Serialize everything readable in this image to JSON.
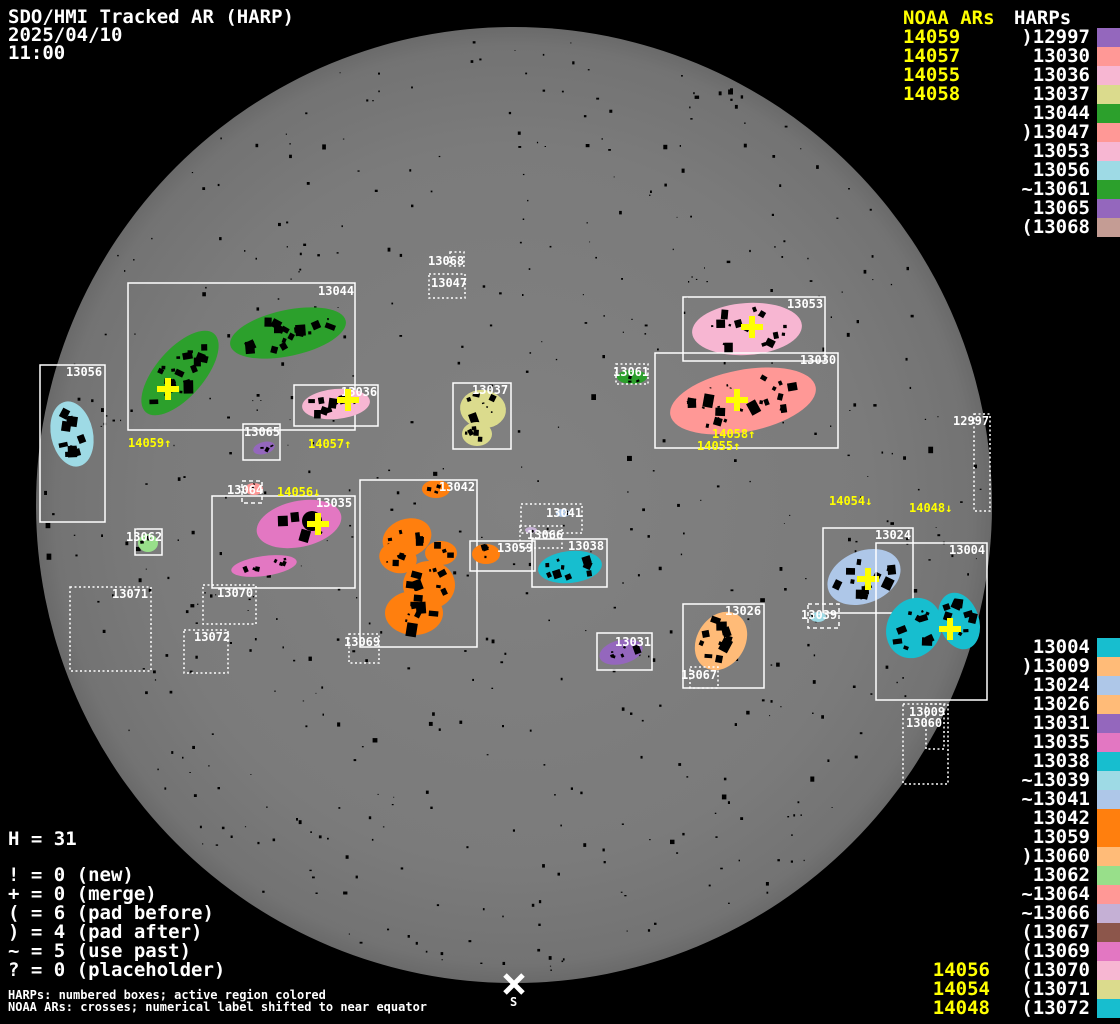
{
  "header": {
    "title": "SDO/HMI Tracked AR (HARP)",
    "date": "2025/04/10",
    "time": "11:00"
  },
  "panel_top_right": {
    "noaa_title": "NOAA ARs",
    "harps_title": "HARPs",
    "noaa_values": [
      "14059",
      "14057",
      "14055",
      "14058"
    ],
    "harps": [
      {
        "label": ")12997",
        "color": "#9467bd"
      },
      {
        "label": "13030",
        "color": "#ff9896"
      },
      {
        "label": "13036",
        "color": "#f7b6d2"
      },
      {
        "label": "13037",
        "color": "#dbdb8d"
      },
      {
        "label": "13044",
        "color": "#2ca02c"
      },
      {
        "label": ")13047",
        "color": "#ff9896"
      },
      {
        "label": "13053",
        "color": "#f7b6d2"
      },
      {
        "label": "13056",
        "color": "#9edae5"
      },
      {
        "label": "~13061",
        "color": "#2ca02c"
      },
      {
        "label": "13065",
        "color": "#9467bd"
      },
      {
        "label": "(13068",
        "color": "#c49c94"
      }
    ]
  },
  "panel_bottom_right": {
    "harps": [
      {
        "label": "13004",
        "color": "#17becf"
      },
      {
        "label": ")13009",
        "color": "#ffbb78"
      },
      {
        "label": "13024",
        "color": "#aec7e8"
      },
      {
        "label": "13026",
        "color": "#ffbb78"
      },
      {
        "label": "13031",
        "color": "#9467bd"
      },
      {
        "label": "13035",
        "color": "#e377c2"
      },
      {
        "label": "13038",
        "color": "#17becf"
      },
      {
        "label": "~13039",
        "color": "#9edae5"
      },
      {
        "label": "~13041",
        "color": "#aec7e8"
      },
      {
        "label": "13042",
        "color": "#ff7f0e"
      },
      {
        "label": "13059",
        "color": "#ff7f0e"
      },
      {
        "label": ")13060",
        "color": "#ffbb78"
      },
      {
        "label": "13062",
        "color": "#98df8a"
      },
      {
        "label": "~13064",
        "color": "#ff9896"
      },
      {
        "label": "~13066",
        "color": "#c5b0d5"
      },
      {
        "label": "(13067",
        "color": "#8c564b"
      },
      {
        "label": "(13069",
        "color": "#e377c2"
      },
      {
        "label": "(13070",
        "color": "#f7b6d2"
      },
      {
        "label": "(13071",
        "color": "#dbdb8d"
      },
      {
        "label": "(13072",
        "color": "#17becf"
      }
    ],
    "noaa_values": [
      "14056",
      "14054",
      "14048"
    ]
  },
  "legend": {
    "h_line": "H = 31",
    "lines": [
      "! = 0 (new)",
      "+ = 0 (merge)",
      "( = 6 (pad before)",
      ") = 4 (pad after)",
      "~ = 5 (use past)",
      "? = 0 (placeholder)"
    ],
    "footnote1": "HARPs: numbered boxes; active region colored",
    "footnote2": "NOAA ARs: crosses; numerical label shifted to near equator"
  },
  "disk": {
    "cx": 514,
    "cy": 505,
    "r": 478,
    "south_label": "S",
    "south_x": 514,
    "south_y": 984
  },
  "colors": {
    "noaa": "#ffff00",
    "box": "#ffffff",
    "label": "#ffffff",
    "speck": "#000000"
  },
  "regions": [
    {
      "id": "13044",
      "box": [
        128,
        283,
        227,
        147
      ],
      "style": "solid",
      "color": "#2ca02c",
      "label": [
        318,
        285
      ],
      "blobs": [
        [
          180,
          373,
          52,
          24,
          -49,
          20
        ],
        [
          288,
          333,
          59,
          23,
          -12,
          20
        ]
      ],
      "cross": [
        168,
        389
      ]
    },
    {
      "id": "13056",
      "box": [
        40,
        365,
        65,
        157
      ],
      "style": "solid",
      "color": "#9edae5",
      "label": [
        66,
        366
      ],
      "blobs": [
        [
          72,
          434,
          21,
          33,
          -12,
          12
        ]
      ]
    },
    {
      "id": "13036",
      "box": [
        294,
        385,
        84,
        41
      ],
      "style": "solid",
      "color": "#f7b6d2",
      "label": [
        341,
        386
      ],
      "blobs": [
        [
          336,
          404,
          34,
          15,
          -5,
          10
        ]
      ],
      "cross": [
        348,
        400
      ]
    },
    {
      "id": "13065",
      "box": [
        243,
        424,
        37,
        36
      ],
      "style": "solid",
      "color": "#9467bd",
      "label": [
        244,
        426
      ],
      "blobs": [
        [
          264,
          448,
          11,
          6,
          -15,
          3
        ]
      ]
    },
    {
      "id": "13037",
      "box": [
        453,
        383,
        58,
        66
      ],
      "style": "solid",
      "color": "#dbdb8d",
      "label": [
        472,
        384
      ],
      "blobs": [
        [
          483,
          409,
          23,
          19,
          8,
          8
        ],
        [
          477,
          434,
          15,
          12,
          0,
          5
        ]
      ]
    },
    {
      "id": "13047",
      "box": [
        429,
        274,
        36,
        24
      ],
      "style": "dotted",
      "color": null,
      "label": [
        431,
        277
      ],
      "blobs": []
    },
    {
      "id": "13068",
      "box": [
        450,
        252,
        14,
        14
      ],
      "style": "dotted",
      "color": null,
      "label": [
        428,
        255
      ],
      "blobs": []
    },
    {
      "id": "13061",
      "box": [
        616,
        364,
        32,
        20
      ],
      "style": "dotted",
      "color": "#2ca02c",
      "label": [
        613,
        366
      ],
      "blobs": [
        [
          632,
          377,
          15,
          7,
          0,
          3
        ]
      ]
    },
    {
      "id": "13053",
      "box": [
        683,
        297,
        142,
        64
      ],
      "style": "solid",
      "color": "#f7b6d2",
      "label": [
        787,
        298
      ],
      "blobs": [
        [
          747,
          329,
          55,
          26,
          -4,
          16
        ]
      ],
      "cross": [
        752,
        327
      ]
    },
    {
      "id": "13030",
      "box": [
        655,
        353,
        183,
        95
      ],
      "style": "solid",
      "color": "#ff9896",
      "label": [
        800,
        354
      ],
      "blobs": [
        [
          743,
          401,
          74,
          31,
          -11,
          26
        ]
      ],
      "cross": [
        737,
        400
      ]
    },
    {
      "id": "13035",
      "box": [
        212,
        496,
        143,
        92
      ],
      "style": "solid",
      "color": "#e377c2",
      "label": [
        316,
        497
      ],
      "blobs": [
        [
          299,
          524,
          43,
          23,
          -12,
          5
        ],
        [
          264,
          566,
          33,
          10,
          -8,
          7
        ]
      ],
      "cross": [
        318,
        524
      ],
      "dark": [
        312,
        521,
        10
      ]
    },
    {
      "id": "13064",
      "box": [
        242,
        481,
        20,
        22
      ],
      "style": "dashed",
      "color": "#ff9896",
      "label": [
        227,
        484
      ],
      "blobs": [
        [
          254,
          489,
          9,
          6,
          0,
          2
        ]
      ]
    },
    {
      "id": "13070",
      "box": [
        203,
        585,
        53,
        39
      ],
      "style": "dotted",
      "color": null,
      "label": [
        217,
        587
      ],
      "blobs": []
    },
    {
      "id": "13071",
      "box": [
        70,
        587,
        81,
        84
      ],
      "style": "dotted",
      "color": null,
      "label": [
        112,
        588
      ],
      "blobs": []
    },
    {
      "id": "13072",
      "box": [
        184,
        630,
        44,
        43
      ],
      "style": "dotted",
      "color": null,
      "label": [
        194,
        631
      ],
      "blobs": []
    },
    {
      "id": "13042",
      "box": [
        360,
        480,
        117,
        167
      ],
      "style": "solid",
      "color": "#ff7f0e",
      "label": [
        439,
        481
      ],
      "blobs": [
        [
          407,
          538,
          25,
          19,
          -20,
          6
        ],
        [
          398,
          558,
          19,
          15,
          15,
          5
        ],
        [
          429,
          585,
          26,
          24,
          0,
          9
        ],
        [
          414,
          613,
          29,
          22,
          0,
          9
        ],
        [
          441,
          553,
          16,
          12,
          0,
          4
        ],
        [
          436,
          489,
          14,
          9,
          0,
          3
        ]
      ]
    },
    {
      "id": "13069",
      "box": [
        349,
        634,
        30,
        29
      ],
      "style": "dotted",
      "color": null,
      "label": [
        344,
        636
      ],
      "blobs": []
    },
    {
      "id": "13059",
      "box": [
        470,
        541,
        65,
        30
      ],
      "style": "solid",
      "color": "#ff7f0e",
      "label": [
        497,
        542
      ],
      "blobs": [
        [
          486,
          554,
          14,
          10,
          0,
          4
        ]
      ]
    },
    {
      "id": "13041",
      "box": [
        521,
        504,
        61,
        29
      ],
      "style": "dotted",
      "color": "#aec7e8",
      "label": [
        546,
        507
      ],
      "blobs": [
        [
          563,
          513,
          7,
          4,
          0,
          2
        ]
      ]
    },
    {
      "id": "13066",
      "box": [
        520,
        526,
        42,
        22
      ],
      "style": "dotted",
      "color": "#c5b0d5",
      "label": [
        527,
        529
      ],
      "blobs": [
        [
          531,
          530,
          6,
          3,
          0,
          1
        ]
      ]
    },
    {
      "id": "13038",
      "box": [
        532,
        539,
        75,
        48
      ],
      "style": "solid",
      "color": "#17becf",
      "label": [
        568,
        540
      ],
      "blobs": [
        [
          570,
          567,
          32,
          16,
          -6,
          9
        ]
      ]
    },
    {
      "id": "13062",
      "box": [
        135,
        529,
        27,
        26
      ],
      "style": "solid",
      "color": "#98df8a",
      "label": [
        126,
        531
      ],
      "blobs": [
        [
          148,
          543,
          10,
          9,
          0,
          3
        ]
      ]
    },
    {
      "id": "13031",
      "box": [
        597,
        633,
        55,
        37
      ],
      "style": "solid",
      "color": "#9467bd",
      "label": [
        615,
        636
      ],
      "blobs": [
        [
          621,
          652,
          22,
          12,
          -14,
          6
        ]
      ]
    },
    {
      "id": "13026",
      "box": [
        683,
        604,
        81,
        84
      ],
      "style": "solid",
      "color": "#ffbb78",
      "label": [
        725,
        605
      ],
      "blobs": [
        [
          721,
          641,
          24,
          31,
          32,
          12
        ]
      ]
    },
    {
      "id": "13067",
      "box": [
        690,
        667,
        28,
        21
      ],
      "style": "dotted",
      "color": null,
      "label": [
        681,
        669
      ],
      "blobs": []
    },
    {
      "id": "13024",
      "box": [
        823,
        528,
        90,
        85
      ],
      "style": "solid",
      "color": "#aec7e8",
      "label": [
        875,
        529
      ],
      "blobs": [
        [
          864,
          577,
          38,
          26,
          -22,
          14
        ]
      ],
      "cross": [
        868,
        579
      ]
    },
    {
      "id": "13004",
      "box": [
        876,
        543,
        111,
        157
      ],
      "style": "solid",
      "color": "#17becf",
      "label": [
        949,
        544
      ],
      "blobs": [
        [
          914,
          628,
          27,
          31,
          28,
          12
        ],
        [
          959,
          621,
          20,
          29,
          -18,
          10
        ]
      ],
      "cross": [
        950,
        629
      ]
    },
    {
      "id": "13039",
      "box": [
        808,
        604,
        31,
        24
      ],
      "style": "dashed",
      "color": "#9edae5",
      "label": [
        801,
        609
      ],
      "blobs": [
        [
          818,
          617,
          8,
          5,
          0,
          2
        ]
      ]
    },
    {
      "id": "13060",
      "box": [
        903,
        704,
        45,
        80
      ],
      "style": "dotted",
      "color": null,
      "label": [
        906,
        717
      ],
      "blobs": []
    },
    {
      "id": "13009",
      "box": [
        926,
        704,
        18,
        45
      ],
      "style": "dotted",
      "color": null,
      "label": [
        909,
        706
      ],
      "blobs": []
    },
    {
      "id": "12997",
      "box": [
        974,
        414,
        16,
        97
      ],
      "style": "dotted",
      "color": null,
      "label": [
        953,
        415
      ],
      "blobs": []
    }
  ],
  "noaa_disk_labels": [
    {
      "text": "14059↑",
      "x": 128,
      "y": 437
    },
    {
      "text": "14057↑",
      "x": 308,
      "y": 438
    },
    {
      "text": "14058↑",
      "x": 712,
      "y": 428
    },
    {
      "text": "14055↑",
      "x": 697,
      "y": 440
    },
    {
      "text": "14056↓",
      "x": 277,
      "y": 486
    },
    {
      "text": "14054↓",
      "x": 829,
      "y": 495
    },
    {
      "text": "14048↓",
      "x": 909,
      "y": 502
    }
  ],
  "chart_data": {
    "type": "table",
    "title": "SDO/HMI Tracked AR (HARP) 2025/04/10 11:00",
    "columns": [
      "HARP",
      "status_prefix",
      "color"
    ],
    "rows": [
      [
        ")12997",
        "pad after",
        "#9467bd"
      ],
      [
        "13030",
        "",
        "#ff9896"
      ],
      [
        "13036",
        "",
        "#f7b6d2"
      ],
      [
        "13037",
        "",
        "#dbdb8d"
      ],
      [
        "13044",
        "",
        "#2ca02c"
      ],
      [
        ")13047",
        "pad after",
        "#ff9896"
      ],
      [
        "13053",
        "",
        "#f7b6d2"
      ],
      [
        "13056",
        "",
        "#9edae5"
      ],
      [
        "~13061",
        "use past",
        "#2ca02c"
      ],
      [
        "13065",
        "",
        "#9467bd"
      ],
      [
        "(13068",
        "pad before",
        "#c49c94"
      ],
      [
        "13004",
        "",
        "#17becf"
      ],
      [
        ")13009",
        "pad after",
        "#ffbb78"
      ],
      [
        "13024",
        "",
        "#aec7e8"
      ],
      [
        "13026",
        "",
        "#ffbb78"
      ],
      [
        "13031",
        "",
        "#9467bd"
      ],
      [
        "13035",
        "",
        "#e377c2"
      ],
      [
        "13038",
        "",
        "#17becf"
      ],
      [
        "~13039",
        "use past",
        "#9edae5"
      ],
      [
        "~13041",
        "use past",
        "#aec7e8"
      ],
      [
        "13042",
        "",
        "#ff7f0e"
      ],
      [
        "13059",
        "",
        "#ff7f0e"
      ],
      [
        ")13060",
        "pad after",
        "#ffbb78"
      ],
      [
        "13062",
        "",
        "#98df8a"
      ],
      [
        "~13064",
        "use past",
        "#ff9896"
      ],
      [
        "~13066",
        "use past",
        "#c5b0d5"
      ],
      [
        "(13067",
        "pad before",
        "#8c564b"
      ],
      [
        "(13069",
        "pad before",
        "#e377c2"
      ],
      [
        "(13070",
        "pad before",
        "#f7b6d2"
      ],
      [
        "(13071",
        "pad before",
        "#dbdb8d"
      ],
      [
        "(13072",
        "pad before",
        "#17becf"
      ]
    ],
    "noaa_ars_on_disk": [
      "14059",
      "14057",
      "14055",
      "14058",
      "14056",
      "14054",
      "14048"
    ],
    "note": "H = 31 tracked HARPs; ! new, + merge, ( pad before, ) pad after, ~ use past, ? placeholder"
  }
}
